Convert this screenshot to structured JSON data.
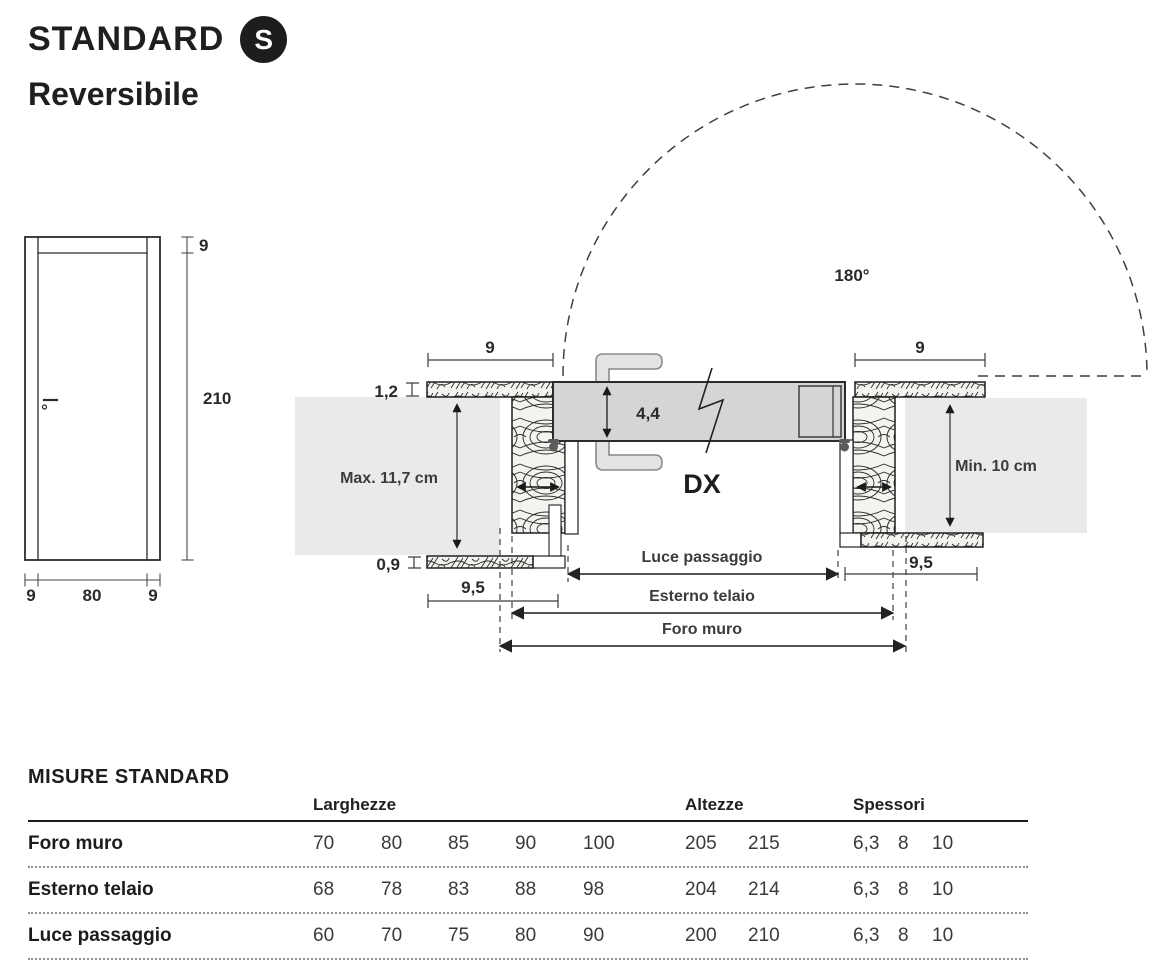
{
  "header": {
    "title": "STANDARD",
    "badge": "S",
    "subtitle": "Reversibile"
  },
  "front_view": {
    "dim_frame_top": "9",
    "dim_height": "210",
    "dim_bottom_left": "9",
    "dim_bottom_center": "80",
    "dim_bottom_right": "9"
  },
  "section_view": {
    "swing_angle": "180°",
    "hand_label": "DX",
    "leaf_thickness": "4,4",
    "frame_width_left": "9",
    "frame_width_right": "9",
    "architrave_thickness": "1,2",
    "architrave_thickness_bottom": "0,9",
    "jamb_depth_left": "9,5",
    "jamb_depth_right": "9,5",
    "wall_max": "Max. 11,7 cm",
    "wall_min": "Min. 10 cm",
    "dim_luce": "Luce passaggio",
    "dim_esterno": "Esterno telaio",
    "dim_foro": "Foro muro"
  },
  "table": {
    "title": "MISURE STANDARD",
    "group_headers": {
      "larghezze": "Larghezze",
      "altezze": "Altezze",
      "spessori": "Spessori"
    },
    "rows": [
      {
        "label": "Foro muro",
        "larghezze": [
          "70",
          "80",
          "85",
          "90",
          "100"
        ],
        "altezze": [
          "205",
          "215"
        ],
        "spessori": [
          "6,3",
          "8",
          "10"
        ]
      },
      {
        "label": "Esterno telaio",
        "larghezze": [
          "68",
          "78",
          "83",
          "88",
          "98"
        ],
        "altezze": [
          "204",
          "214"
        ],
        "spessori": [
          "6,3",
          "8",
          "10"
        ]
      },
      {
        "label": "Luce passaggio",
        "larghezze": [
          "60",
          "70",
          "75",
          "80",
          "90"
        ],
        "altezze": [
          "200",
          "210"
        ],
        "spessori": [
          "6,3",
          "8",
          "10"
        ]
      }
    ]
  },
  "colors": {
    "ink": "#1d1d1b",
    "wall_gray": "#eaeaea",
    "leaf_gray": "#d5d5d5",
    "line": "#3a3a3a"
  }
}
